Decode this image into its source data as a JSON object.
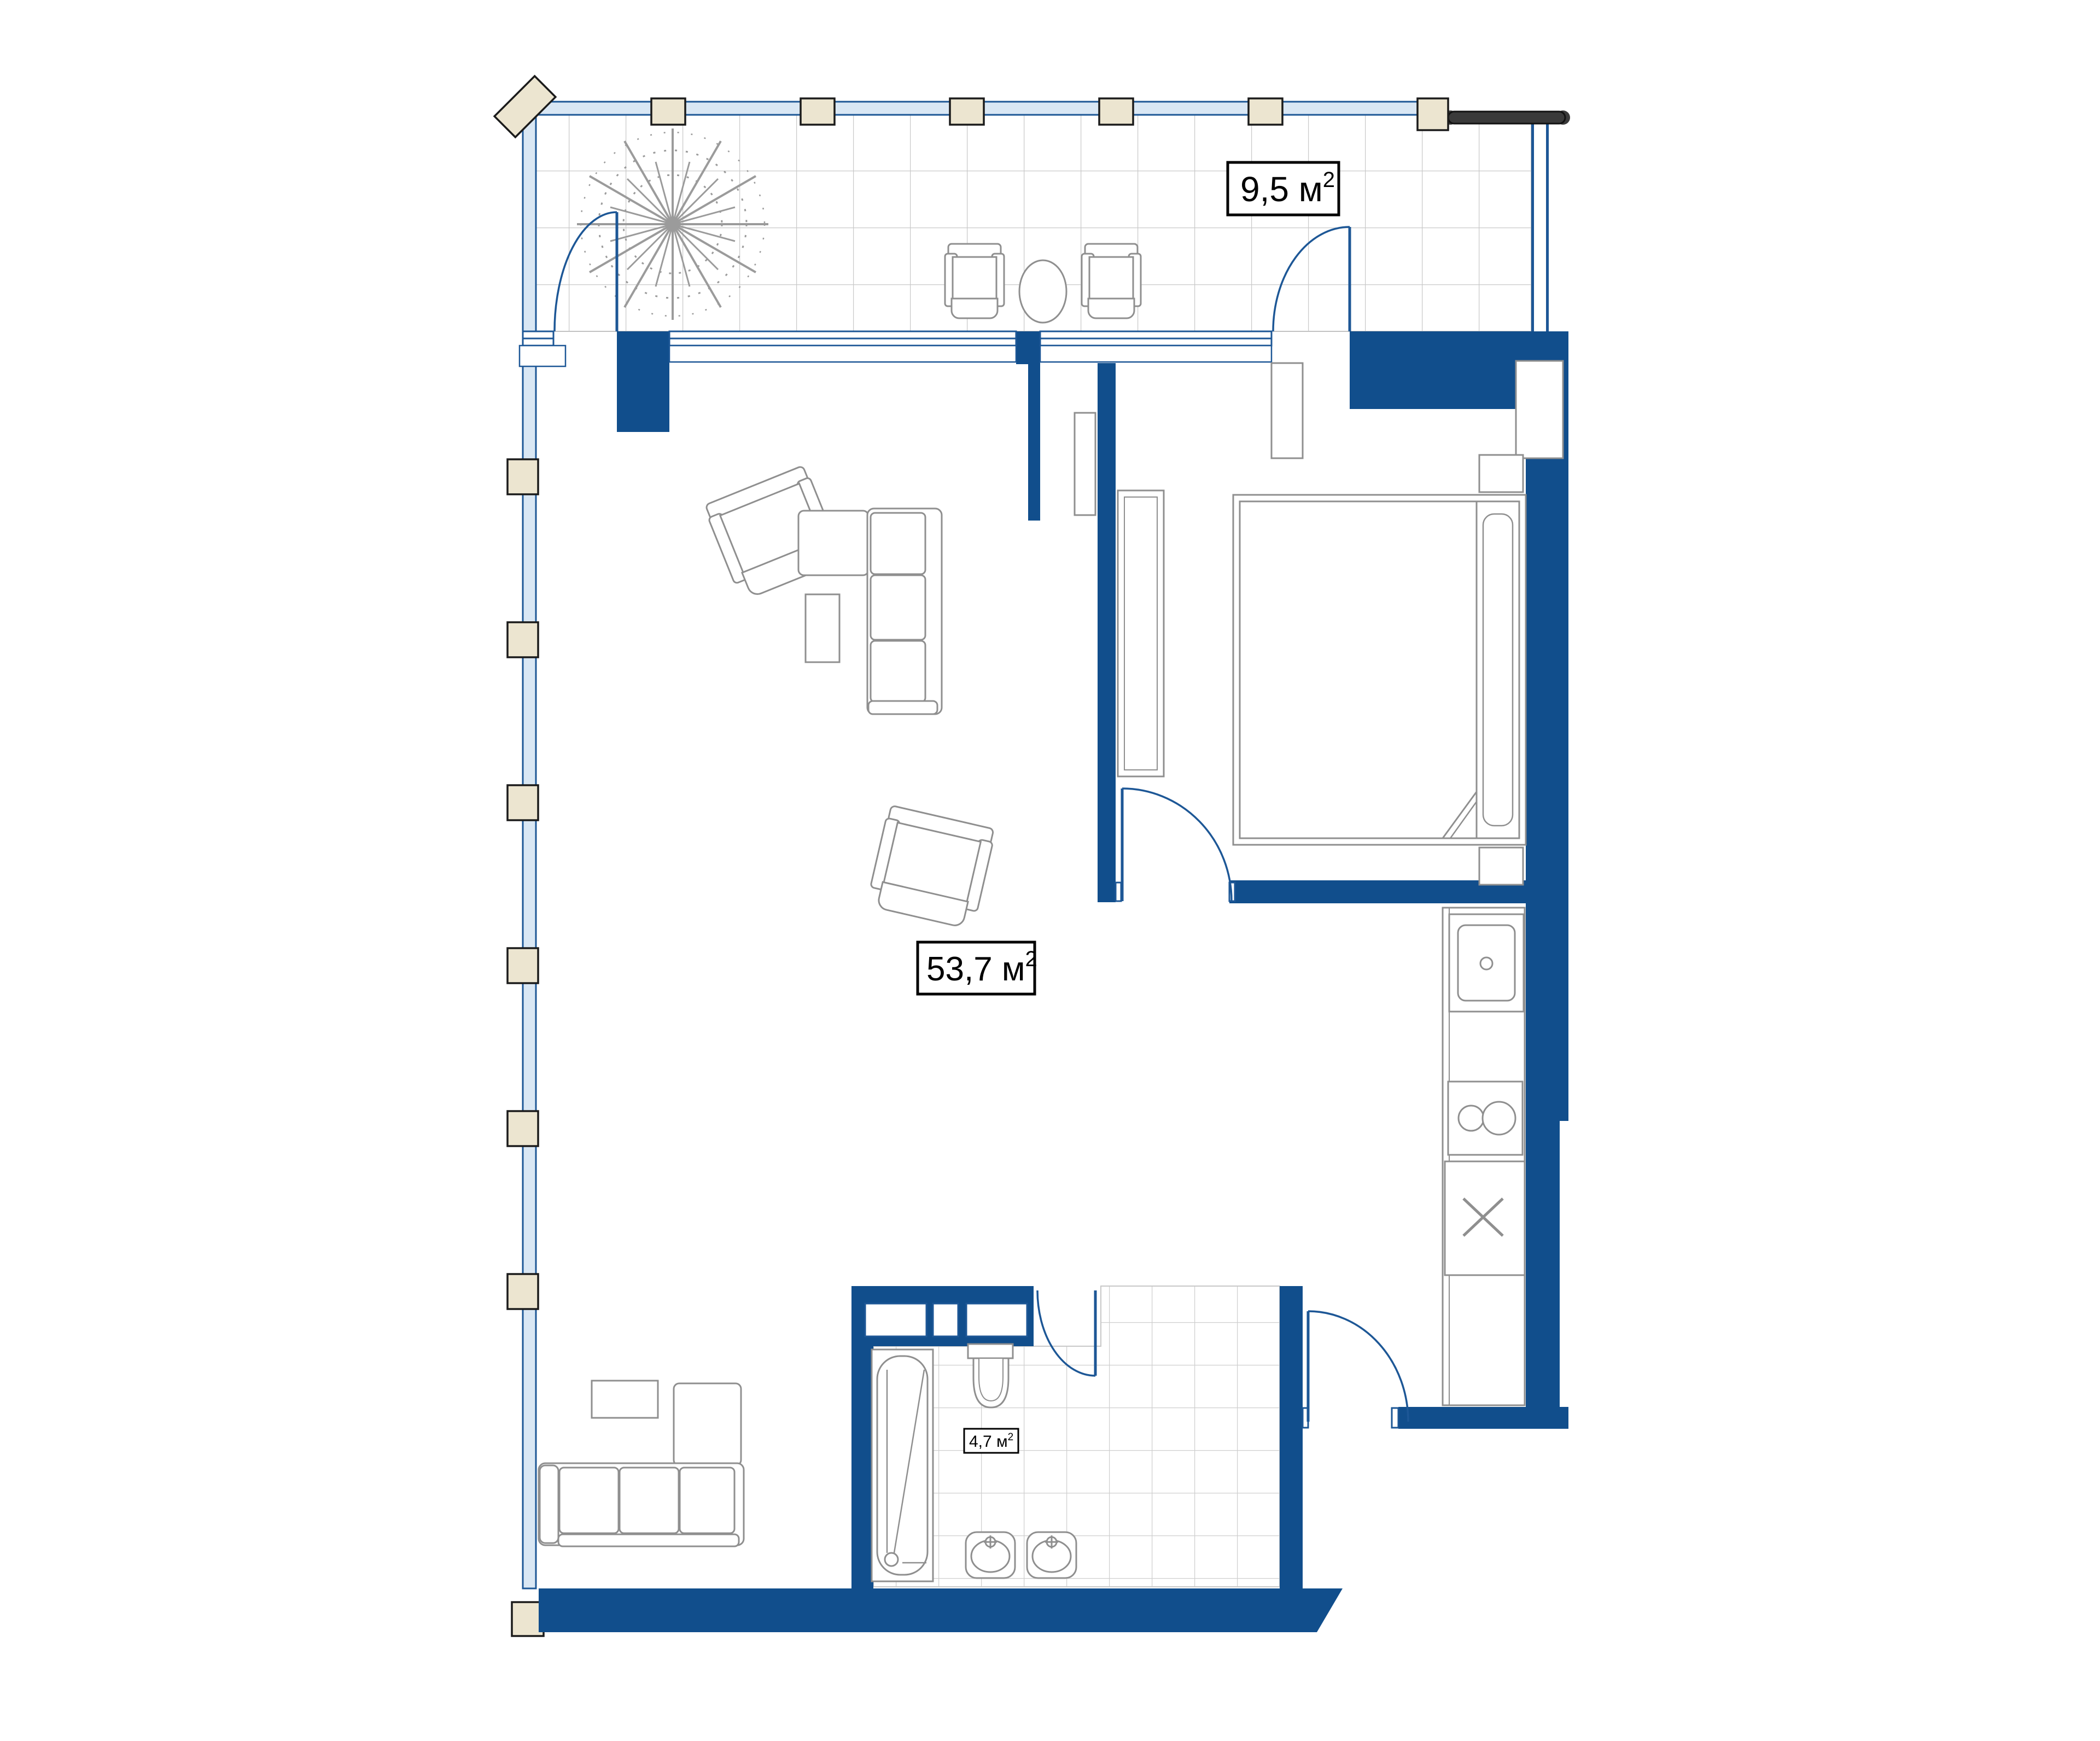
{
  "plan": {
    "type": "apartment-floor-plan",
    "rooms": [
      {
        "id": "terrace",
        "area_label_full": "9,5 м²",
        "label_main": "9,5 м",
        "label_sup": "2"
      },
      {
        "id": "living",
        "area_label_full": "53,7 м²",
        "label_main": "53,7 м",
        "label_sup": "2"
      },
      {
        "id": "bathroom",
        "area_label_full": "4,7 м²",
        "label_main": "4,7 м",
        "label_sup": "2"
      }
    ],
    "fixtures": [
      "tree",
      "terrace-chair",
      "terrace-table",
      "terrace-chair",
      "corner-sofa",
      "armchair",
      "armchair",
      "coffee-table",
      "tv-bench",
      "bed",
      "nightstand",
      "nightstand",
      "wardrobe",
      "closet",
      "kitchen-sink",
      "hob",
      "appliance",
      "corner-sofa",
      "coffee-table",
      "bathtub",
      "toilet",
      "washbasin",
      "washbasin"
    ],
    "colors": {
      "wall": "#114e8c",
      "door": "#1d5796",
      "furniture_outline": "#8f8f8f",
      "tile_line": "#cdcdcd",
      "glass_wall_fill": "#d9e7f4",
      "post_fill": "#ece5d0",
      "post_border": "#1b1b1b",
      "railing": "#3a3a3a",
      "label_border": "#000000",
      "label_bg": "#ffffff",
      "background": "#ffffff"
    }
  }
}
